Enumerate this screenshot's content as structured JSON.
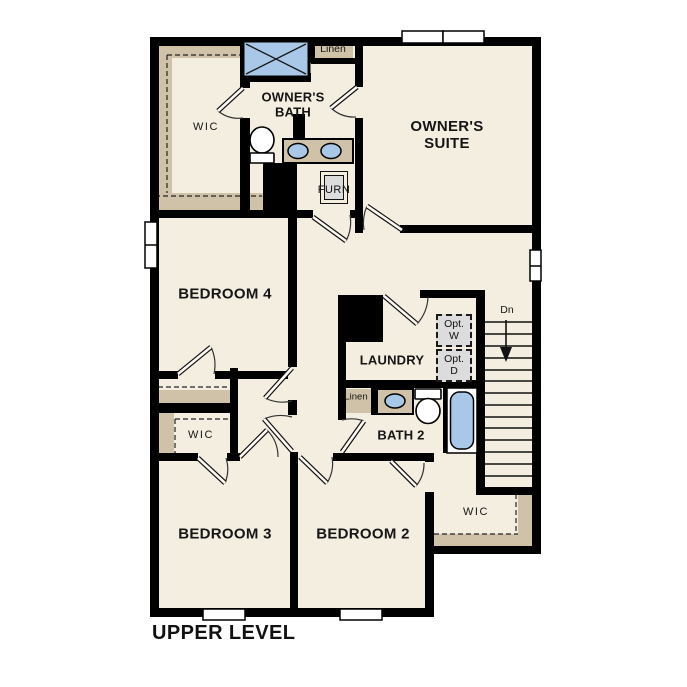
{
  "plan": {
    "title": "UPPER LEVEL",
    "rooms": {
      "owners_suite": "OWNER'S SUITE",
      "owners_bath": "OWNER'S BATH",
      "bedroom4": "BEDROOM 4",
      "bedroom3": "BEDROOM 3",
      "bedroom2": "BEDROOM 2",
      "laundry": "LAUNDRY",
      "bath2": "BATH 2",
      "wic_owners": "WIC",
      "wic_bedroom3": "WIC",
      "wic_bedroom2": "WIC"
    },
    "closets": {
      "linen_upper": "Linen",
      "linen_bath2": "Linen",
      "furnace": "FURN"
    },
    "appliances": {
      "optional_washer": {
        "line1": "Opt.",
        "line2": "W"
      },
      "optional_dryer": {
        "line1": "Opt.",
        "line2": "D"
      }
    },
    "stairs": {
      "direction": "Dn"
    },
    "colors": {
      "floor": "#f4eee1",
      "shelf_tan": "#cfc2a8",
      "fixture_blue": "#a9c8e8",
      "appliance_gray": "#dcdcdc",
      "wall": "#000000"
    }
  }
}
